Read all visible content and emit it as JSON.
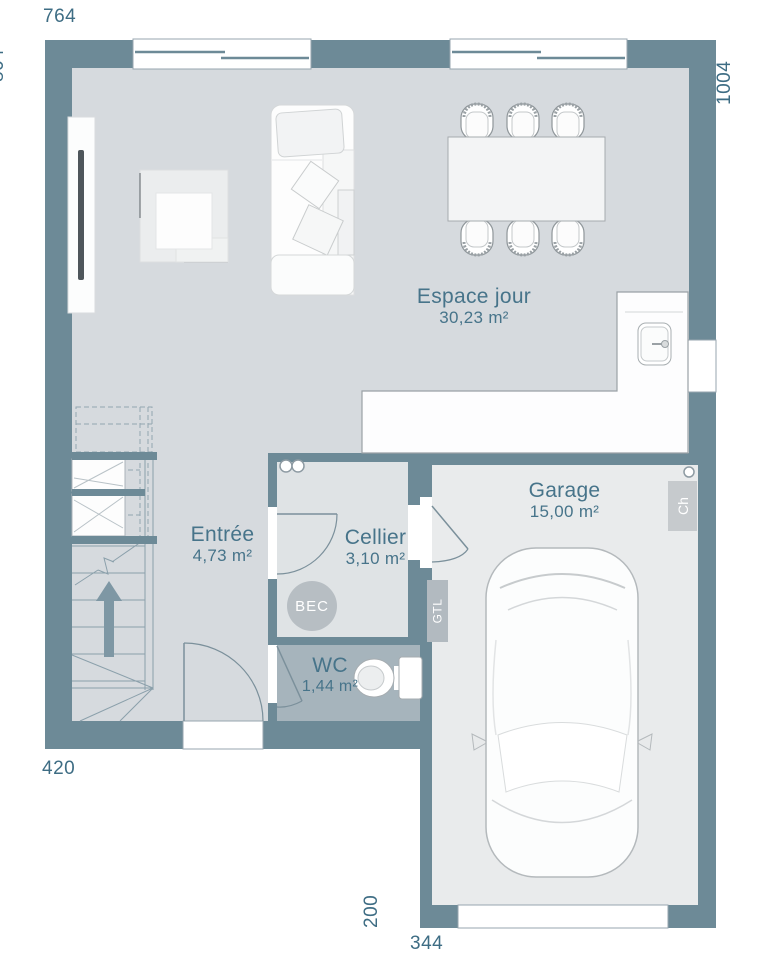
{
  "dimensions": {
    "top": "764",
    "left": "804",
    "right": "1004",
    "bottom_left": "420",
    "garage_left": "200",
    "garage_bottom": "344"
  },
  "rooms": {
    "espace_jour": {
      "name": "Espace jour",
      "area": "30,23 m²"
    },
    "entree": {
      "name": "Entrée",
      "area": "4,73 m²"
    },
    "cellier": {
      "name": "Cellier",
      "area": "3,10 m²"
    },
    "wc": {
      "name": "WC",
      "area": "1,44 m²"
    },
    "garage": {
      "name": "Garage",
      "area": "15,00 m²"
    }
  },
  "badges": {
    "bec": "BEC",
    "ch": "Ch",
    "gtl": "GTL"
  },
  "colors": {
    "wall": "#6d8a97",
    "floor_main": "#d6dade",
    "floor_cellier": "#dfe3e5",
    "floor_wc": "#a6b4bc",
    "floor_garage": "#e9ebec",
    "label_text": "#47748a",
    "dimension_text": "#3e6d84",
    "badge_gray": "#b7bec3"
  }
}
